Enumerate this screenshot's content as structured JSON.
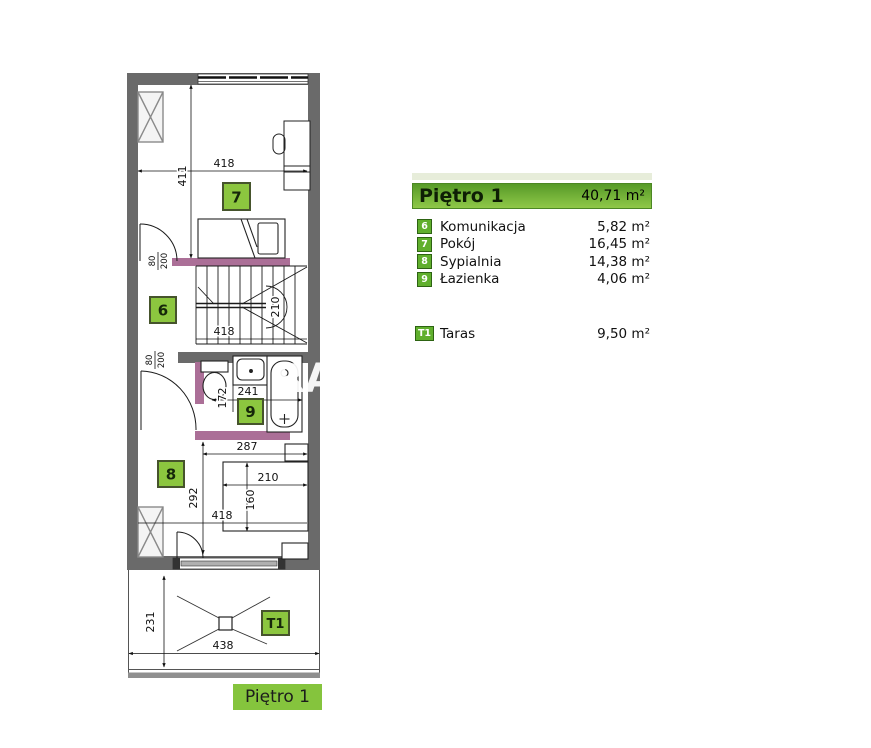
{
  "legend": {
    "title": "Piętro 1",
    "total_area": "40,71 m²",
    "rooms": [
      {
        "id": "6",
        "name": "Komunikacja",
        "area": "5,82 m²"
      },
      {
        "id": "7",
        "name": "Pokój",
        "area": "16,45 m²"
      },
      {
        "id": "8",
        "name": "Sypialnia",
        "area": "14,38 m²"
      },
      {
        "id": "9",
        "name": "Łazienka",
        "area": "4,06 m²"
      }
    ],
    "terrace": {
      "id": "T1",
      "name": "Taras",
      "area": "9,50 m²"
    }
  },
  "floor_label": "Piętro 1",
  "watermark": "RA",
  "plan": {
    "badges": {
      "r6": "6",
      "r7": "7",
      "r8": "8",
      "r9": "9",
      "t1": "T1"
    },
    "dims": {
      "room7_width": "418",
      "room7_depth": "411",
      "stairs_width": "418",
      "stairs_turn": "210",
      "door_upper": {
        "w": "80",
        "h": "200"
      },
      "door_lower": {
        "w": "80",
        "h": "200"
      },
      "bath_width": "241",
      "bath_depth": "172",
      "room8_inner_width": "287",
      "bed_width": "210",
      "bed_depth": "160",
      "room8_depth": "292",
      "room8_width": "418",
      "terrace_depth": "231",
      "terrace_width": "438"
    }
  },
  "colors": {
    "wall": "#6a6a6a",
    "accent_wall": "#ab6f97",
    "plan_badge_green": "#8cc63f",
    "legend_badge_green": "#60af2d",
    "header_green_dark": "#579a28",
    "header_green_light": "#8fc848",
    "label_green": "#85c43d"
  }
}
